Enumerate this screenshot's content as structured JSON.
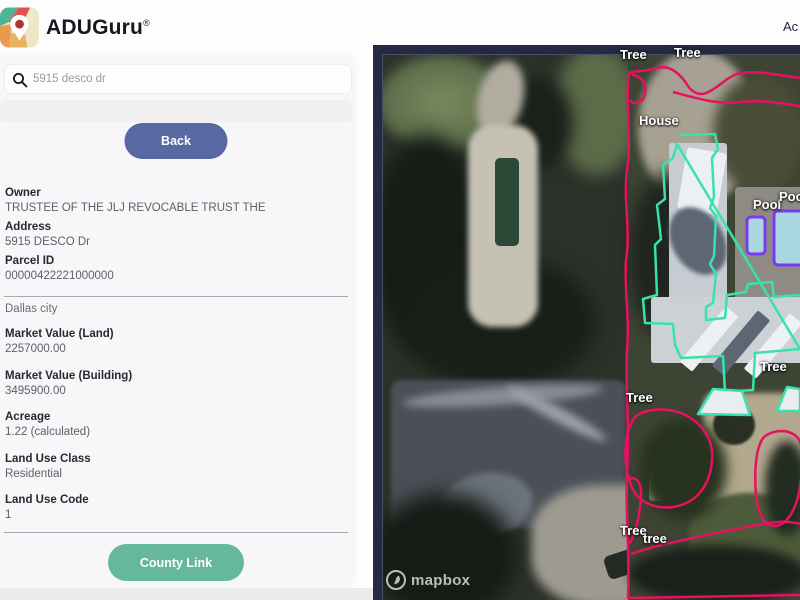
{
  "header": {
    "brand": "ADUGuru",
    "registered_mark": "®",
    "account_link": "Ac"
  },
  "search": {
    "value": "5915 desco dr"
  },
  "buttons": {
    "back": "Back",
    "county_link": "County Link"
  },
  "sidebar": {
    "city": "Dallas city",
    "fields": [
      {
        "label": "Owner",
        "value": "TRUSTEE OF THE JLJ REVOCABLE TRUST THE"
      },
      {
        "label": "Address",
        "value": "5915 DESCO Dr"
      },
      {
        "label": "Parcel ID",
        "value": "00000422221000000"
      },
      {
        "label": "Market Value (Land)",
        "value": "2257000.00"
      },
      {
        "label": "Market Value (Building)",
        "value": "3495900.00"
      },
      {
        "label": "Acreage",
        "value": "1.22 (calculated)"
      },
      {
        "label": "Land Use Class",
        "value": "Residential"
      },
      {
        "label": "Land Use Code",
        "value": "1"
      }
    ]
  },
  "map": {
    "attribution": "mapbox",
    "labels": [
      "Tree",
      "Tree",
      "House",
      "Pool",
      "Pool",
      "Tree",
      "Tree",
      "Tree",
      "tree"
    ],
    "annotation_colors": {
      "tree_outline": "#e8115f",
      "house_outline": "#38e2ab",
      "pool_outline": "#7a3bf0",
      "pool_fill": "#a9d6df"
    }
  }
}
